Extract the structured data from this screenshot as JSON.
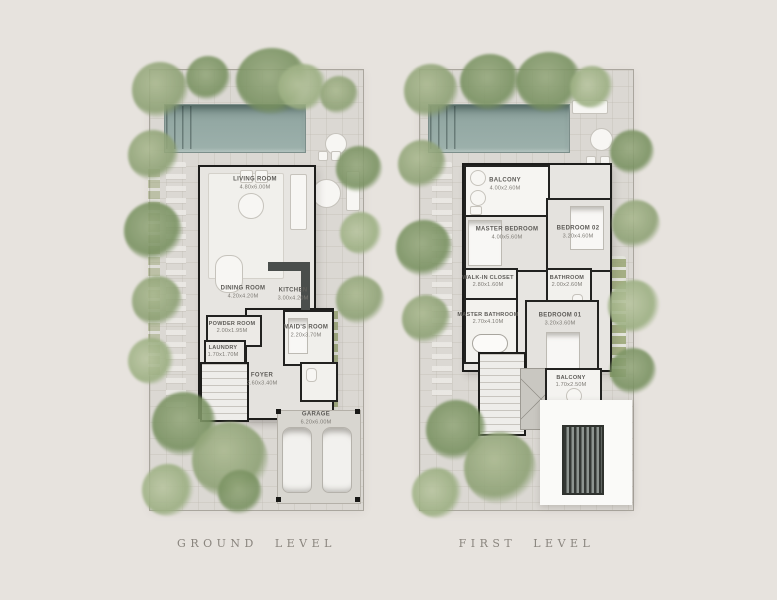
{
  "sheet": {
    "background_color": "#e7e3de",
    "caption_color": "#8a857e",
    "pool_color": "#93a8a3",
    "tree_color": "#8ca073",
    "wall_color": "#1d1d1b"
  },
  "plans": [
    {
      "caption": "GROUND LEVEL",
      "rooms": [
        {
          "name": "LIVING ROOM",
          "dims": "4.80x6.00M"
        },
        {
          "name": "DINING ROOM",
          "dims": "4.20x4.20M"
        },
        {
          "name": "KITCHEN",
          "dims": "3.00x4.20M"
        },
        {
          "name": "POWDER ROOM",
          "dims": "2.00x1.95M"
        },
        {
          "name": "LAUNDRY",
          "dims": "1.70x1.70M"
        },
        {
          "name": "MAID'S ROOM",
          "dims": "2.20x3.70M"
        },
        {
          "name": "FOYER",
          "dims": "2.60x3.40M"
        },
        {
          "name": "GARAGE",
          "dims": "6.20x6.00M"
        }
      ]
    },
    {
      "caption": "FIRST LEVEL",
      "rooms": [
        {
          "name": "BALCONY",
          "dims": "4.00x2.60M"
        },
        {
          "name": "MASTER BEDROOM",
          "dims": "4.00x5.60M"
        },
        {
          "name": "BEDROOM 02",
          "dims": "3.20x4.60M"
        },
        {
          "name": "WALK-IN CLOSET",
          "dims": "2.80x1.60M"
        },
        {
          "name": "MASTER BATHROOM",
          "dims": "2.70x4.10M"
        },
        {
          "name": "BATHROOM",
          "dims": "2.00x2.60M"
        },
        {
          "name": "BEDROOM 01",
          "dims": "3.20x3.60M"
        },
        {
          "name": "BALCONY",
          "dims": "1.70x2.50M"
        }
      ]
    }
  ]
}
